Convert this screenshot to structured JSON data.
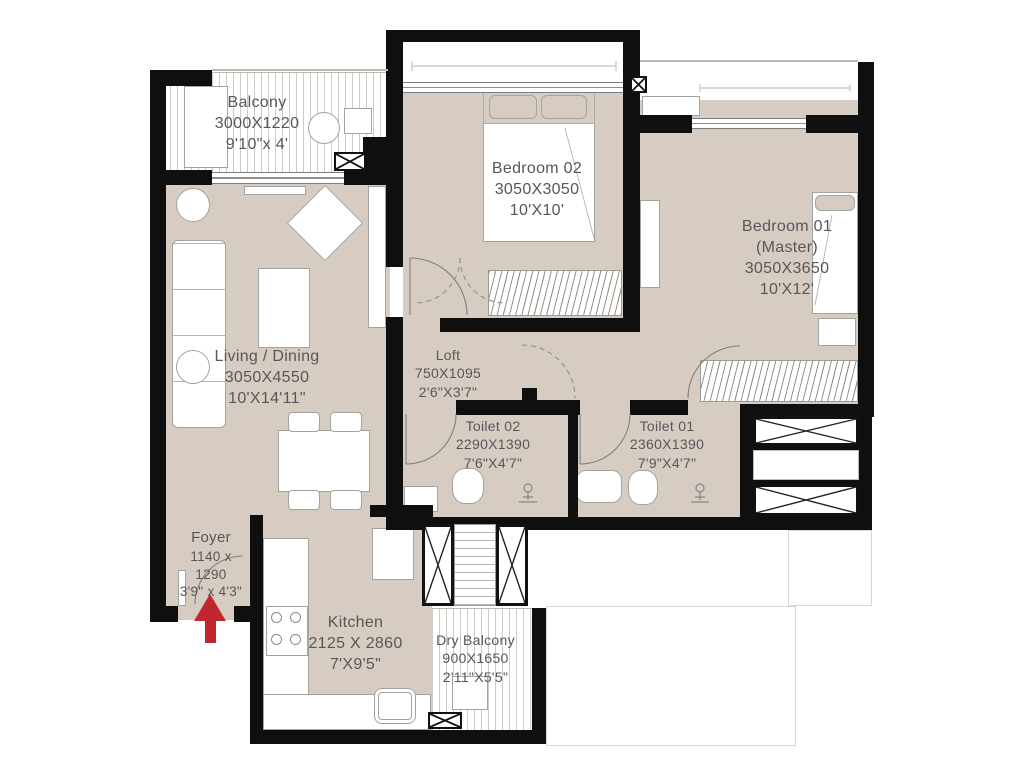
{
  "colors": {
    "floor_fill": "#d7ccc2",
    "wall": "#0f0f0f",
    "entry_arrow": "#c1272d",
    "label_text": "#57575a"
  },
  "rooms": [
    {
      "id": "balcony",
      "name": "Balcony",
      "mm": "3000X1220",
      "ft": "9'10\"x 4'"
    },
    {
      "id": "bedroom-02",
      "name": "Bedroom 02",
      "mm": "3050X3050",
      "ft": "10'X10'"
    },
    {
      "id": "bedroom-01",
      "name": "Bedroom 01",
      "sub": "(Master)",
      "mm": "3050X3650",
      "ft": "10'X12'"
    },
    {
      "id": "living-dining",
      "name": "Living / Dining",
      "mm": "3050X4550",
      "ft": "10'X14'11\""
    },
    {
      "id": "loft",
      "name": "Loft",
      "mm": "750X1095",
      "ft": "2'6\"X3'7\""
    },
    {
      "id": "toilet-02",
      "name": "Toilet 02",
      "mm": "2290X1390",
      "ft": "7'6\"X4'7\""
    },
    {
      "id": "toilet-01",
      "name": "Toilet 01",
      "mm": "2360X1390",
      "ft": "7'9\"X4'7\""
    },
    {
      "id": "foyer",
      "name": "Foyer",
      "mm1": "1140 x",
      "mm2": "1290",
      "ft": "3'9\" x 4'3\""
    },
    {
      "id": "kitchen",
      "name": "Kitchen",
      "mm": "2125 X 2860",
      "ft": "7'X9'5\""
    },
    {
      "id": "dry-balcony",
      "name": "Dry Balcony",
      "mm": "900X1650",
      "ft": "2'11\"X5'5\""
    }
  ]
}
